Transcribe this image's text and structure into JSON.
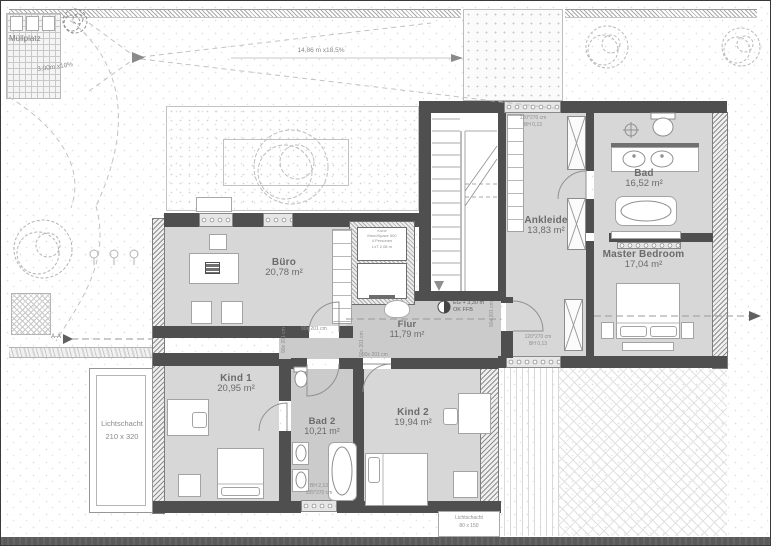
{
  "colors": {
    "wall": "#4f4f4f",
    "room-fill": "#d7d7d7",
    "hall-fill": "#cbcbcb",
    "line": "#9b9b9b",
    "text": "#6b6b6b",
    "band": "#5a5a5a"
  },
  "site": {
    "muellplatz_label": "Müllplatz",
    "ramp_slope": "3,00m x10%",
    "driveway_dimension": "14,86 m x18,5%",
    "section_marker": "A-A",
    "lichtschacht_west": {
      "title": "Lichtschacht",
      "size": "210 x 320"
    },
    "lichtschacht_south": {
      "title": "Lichtschacht",
      "size": "80 x 150"
    }
  },
  "rooms": {
    "buero": {
      "name": "Büro",
      "area": "20,78 m²"
    },
    "flur": {
      "name": "Flur",
      "area": "11,79 m²"
    },
    "ankleide": {
      "name": "Ankleide",
      "area": "13,83 m²"
    },
    "bad": {
      "name": "Bad",
      "area": "16,52 m²"
    },
    "master_bedroom": {
      "name": "Master Bedroom",
      "area": "17,04 m²"
    },
    "kind1": {
      "name": "Kind 1",
      "area": "20,95 m²"
    },
    "bad2": {
      "name": "Bad 2",
      "area": "10,21 m²"
    },
    "kind2": {
      "name": "Kind 2",
      "area": "19,94 m²"
    }
  },
  "annotations": {
    "level_marker": {
      "line1": "EG + 3,30 m",
      "line2": "OK FFB"
    },
    "door_size": "90x 201 cm",
    "window_north": {
      "line1": "120*270 cm",
      "line2": "BH 0,13"
    },
    "window_south": {
      "line1": "120*270 cm",
      "line2": "BH 0,13"
    },
    "window_basement": {
      "line1": "BH 2,13",
      "line2": "135*270 cm"
    },
    "elevator": {
      "line1": "Kone",
      "line2": "MonoSpace 500",
      "line3": "4 Personen",
      "line4": "LxT 2,08 m"
    }
  }
}
